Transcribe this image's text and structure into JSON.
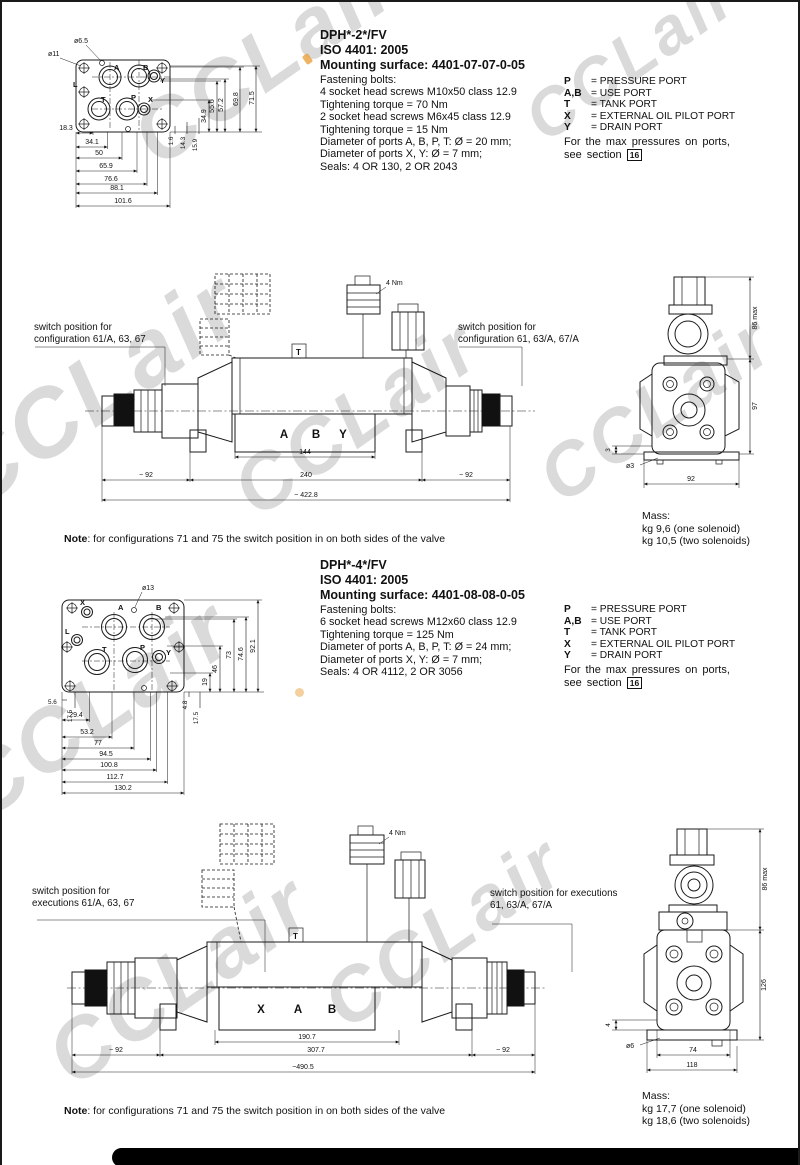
{
  "watermark": {
    "text": "CCLair"
  },
  "s1": {
    "title": "DPH*-2*/FV",
    "iso": "ISO 4401: 2005",
    "mounting": "Mounting surface: 4401-07-07-0-05",
    "specs": [
      "Fastening bolts:",
      "4 socket head screws M10x50 class 12.9",
      "Tightening torque = 70 Nm",
      "2 socket head screws M6x45 class 12.9",
      "Tightening torque = 15 Nm",
      "Diameter of ports A, B, P, T: Ø = 20 mm;",
      "Diameter of ports X, Y: Ø = 7 mm;",
      "Seals: 4 OR 130, 2 OR 2043"
    ],
    "ports": [
      {
        "k": "P",
        "v": "= PRESSURE PORT"
      },
      {
        "k": "A,B",
        "v": "= USE PORT"
      },
      {
        "k": "T",
        "v": "= TANK PORT"
      },
      {
        "k": "X",
        "v": "= EXTERNAL OIL PILOT PORT"
      },
      {
        "k": "Y",
        "v": "= DRAIN PORT"
      }
    ],
    "maxp1": "For the max pressures on ports,",
    "maxp2": "see section",
    "section_ref": "16",
    "mount": {
      "lead1": "ø11",
      "lead2": "ø6.5",
      "letters": {
        "L": "L",
        "A": "A",
        "B": "B",
        "Y": "Y",
        "T": "T",
        "P": "P",
        "X": "X"
      },
      "hdims": [
        "18.3",
        "34.1",
        "50",
        "65.9",
        "76.6",
        "88.1",
        "101.6"
      ],
      "vdims": [
        "34.9",
        "55.6",
        "57.2",
        "69.8",
        "71.5"
      ],
      "vsmall": [
        "1.6",
        "14.3",
        "15.9"
      ]
    },
    "valve": {
      "sw_left1": "switch position for",
      "sw_left2": "configuration 61/A, 63, 67",
      "sw_right1": "switch position for",
      "sw_right2": "configuration 61, 63/A, 67/A",
      "torque": "4 Nm",
      "t_mark": "T",
      "letters": [
        "A",
        "B",
        "Y"
      ],
      "dim_inner": "144",
      "dim_mid": "240",
      "dim_total": "~ 422.8",
      "dim_left": "~ 92",
      "dim_right": "~ 92"
    },
    "end": {
      "d1": "86 max",
      "d2": "97",
      "d3": "3",
      "d4": "ø3",
      "d5": "92"
    },
    "mass": {
      "l0": "Mass:",
      "l1": "kg 9,6 (one solenoid)",
      "l2": "kg 10,5 (two solenoids)"
    },
    "note_b": "Note",
    "note_t": ": for configurations 71 and 75 the switch position in on both sides of the valve"
  },
  "s2": {
    "title": "DPH*-4*/FV",
    "iso": "ISO 4401: 2005",
    "mounting": "Mounting surface: 4401-08-08-0-05",
    "specs": [
      "Fastening bolts:",
      "6 socket head screws M12x60 class 12.9",
      "Tightening torque = 125 Nm",
      "Diameter of ports A, B, P, T: Ø = 24 mm;",
      "Diameter of ports X, Y: Ø = 7 mm;",
      "Seals: 4 OR 4112, 2 OR 3056"
    ],
    "ports": [
      {
        "k": "P",
        "v": "= PRESSURE PORT"
      },
      {
        "k": "A,B",
        "v": "= USE PORT"
      },
      {
        "k": "T",
        "v": "= TANK PORT"
      },
      {
        "k": "X",
        "v": "= EXTERNAL OIL PILOT PORT"
      },
      {
        "k": "Y",
        "v": "= DRAIN PORT"
      }
    ],
    "maxp1": "For the max pressures on ports,",
    "maxp2": "see section",
    "section_ref": "16",
    "mount": {
      "lead1": "ø13",
      "letters": {
        "X": "X",
        "A": "A",
        "B": "B",
        "L": "L",
        "T": "T",
        "P": "P",
        "Y": "Y"
      },
      "hdims": [
        "5.6",
        "17.5",
        "29.4",
        "53.2",
        "77",
        "94.5",
        "100.8",
        "112.7",
        "130.2"
      ],
      "vdims": [
        "19",
        "46",
        "73",
        "74.6",
        "92.1"
      ],
      "vsmall": [
        "4.8",
        "17.5"
      ]
    },
    "valve": {
      "sw_left1": "switch position for",
      "sw_left2": "executions 61/A, 63, 67",
      "sw_right1": "switch position for executions",
      "sw_right2": "61, 63/A, 67/A",
      "torque": "4 Nm",
      "t_mark": "T",
      "letters": [
        "X",
        "A",
        "B"
      ],
      "dim_inner": "190.7",
      "dim_mid": "307.7",
      "dim_total": "~490.5",
      "dim_left": "~ 92",
      "dim_right": "~ 92"
    },
    "end": {
      "d1": "86 max",
      "d2": "126",
      "d3": "4",
      "d4": "ø6",
      "d5": "74",
      "d6": "118"
    },
    "mass": {
      "l0": "Mass:",
      "l1": "kg 17,7 (one solenoid)",
      "l2": "kg 18,6 (two solenoids)"
    },
    "note_b": "Note",
    "note_t": ": for configurations 71 and 75 the switch position in on both sides of the valve"
  }
}
